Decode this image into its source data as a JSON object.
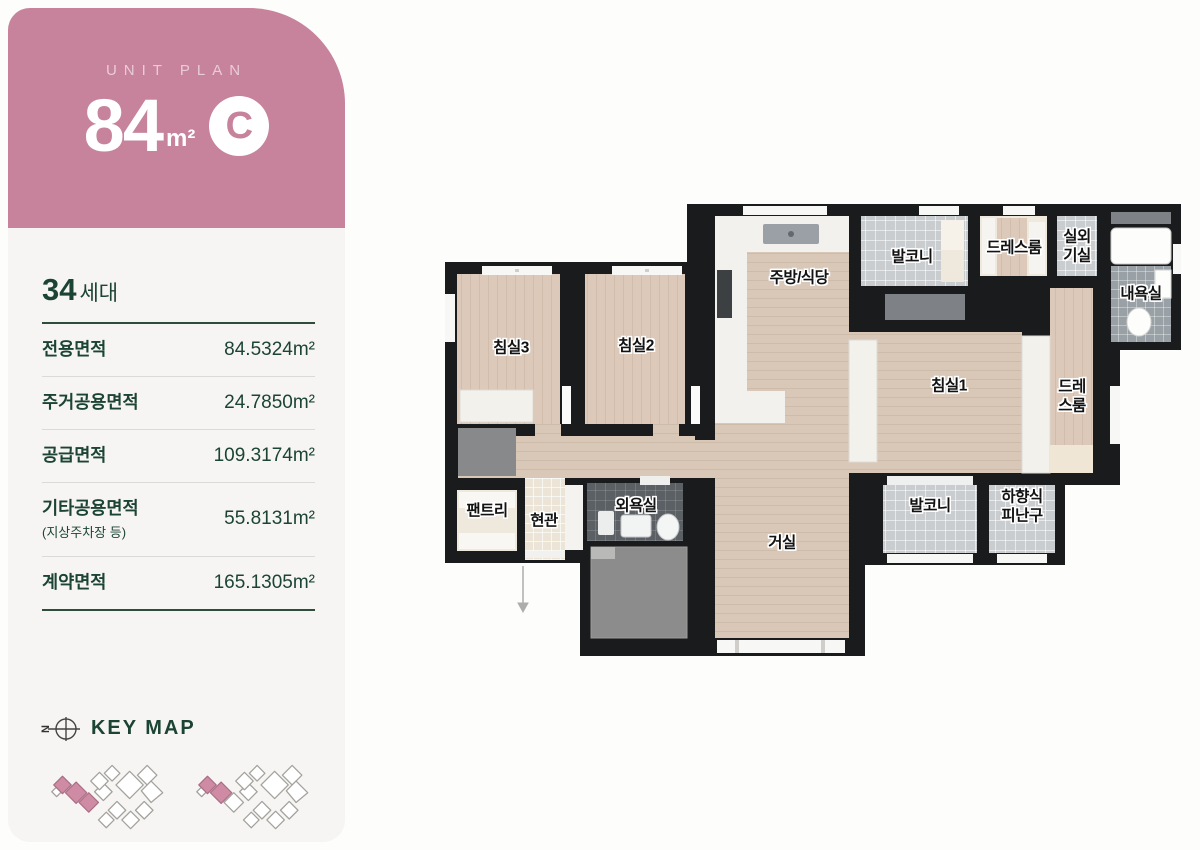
{
  "header": {
    "eyebrow": "UNIT PLAN",
    "area_number": "84",
    "area_unit": "m²",
    "type_letter": "C"
  },
  "summary": {
    "households_number": "34",
    "households_suffix": "세대",
    "rows": [
      {
        "label": "전용면적",
        "value": "84.5324m²"
      },
      {
        "label": "주거공용면적",
        "value": "24.7850m²"
      },
      {
        "label": "공급면적",
        "value": "109.3174m²"
      },
      {
        "label": "기타공용면적",
        "sublabel": "(지상주차장 등)",
        "value": "55.8131m²"
      },
      {
        "label": "계약면적",
        "value": "165.1305m²"
      }
    ]
  },
  "keymap": {
    "title": "KEY MAP",
    "compass_letter": "N"
  },
  "plan": {
    "rooms": {
      "bedroom3": "침실3",
      "bedroom2": "침실2",
      "kitchen": "주방/식당",
      "balcony_top": "발코니",
      "dressroom_top": "드레스룸",
      "outdoor_unit": "실외\n기실",
      "master_bath": "내욕실",
      "bedroom1": "침실1",
      "dressroom_right": "드레\n스룸",
      "pantry": "팬트리",
      "entrance": "현관",
      "common_bath": "외욕실",
      "living": "거실",
      "balcony_bottom": "발코니",
      "escape_hatch": "하향식\n피난구"
    }
  },
  "colors": {
    "accent_pink": "#c7829c",
    "text_green": "#1c4434",
    "wall_black": "#1a1b1d",
    "wood_floor": "#d9c8b8",
    "tile_gray": "#c9cdd0",
    "tile_dark": "#5b6064",
    "keymap_highlight": "#cf8aa4"
  }
}
